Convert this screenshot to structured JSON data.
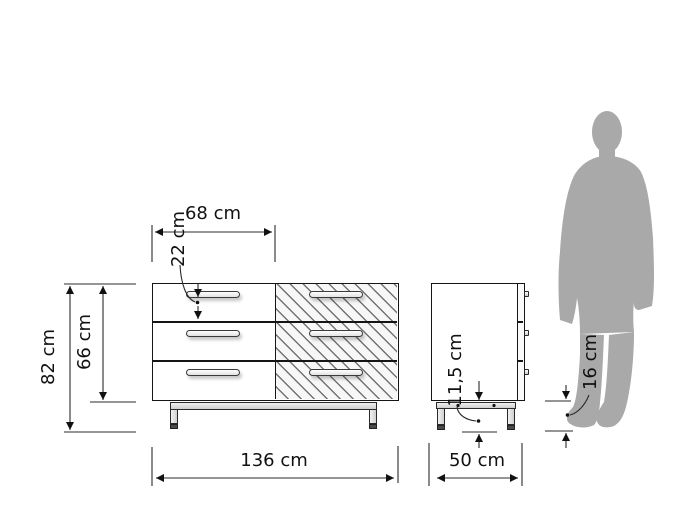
{
  "diagram": {
    "views": {
      "front_view": "dresser-front-three-drawer-rows-two-columns",
      "side_view": "dresser-side",
      "scale_figure": "standing-man-silhouette"
    },
    "dimensions": {
      "total_width": "136 cm",
      "half_width": "68 cm",
      "total_height": "82 cm",
      "body_height": "66 cm",
      "drawer_front_height": "22 cm",
      "depth": "50 cm",
      "underframe_clearance": "11,5 cm",
      "leg_clearance": "16 cm"
    },
    "colors": {
      "line": "#151515",
      "silhouette": "#a9a9a9",
      "hatch_line": "#464646",
      "metal_frame": "#d8d8d8"
    }
  }
}
